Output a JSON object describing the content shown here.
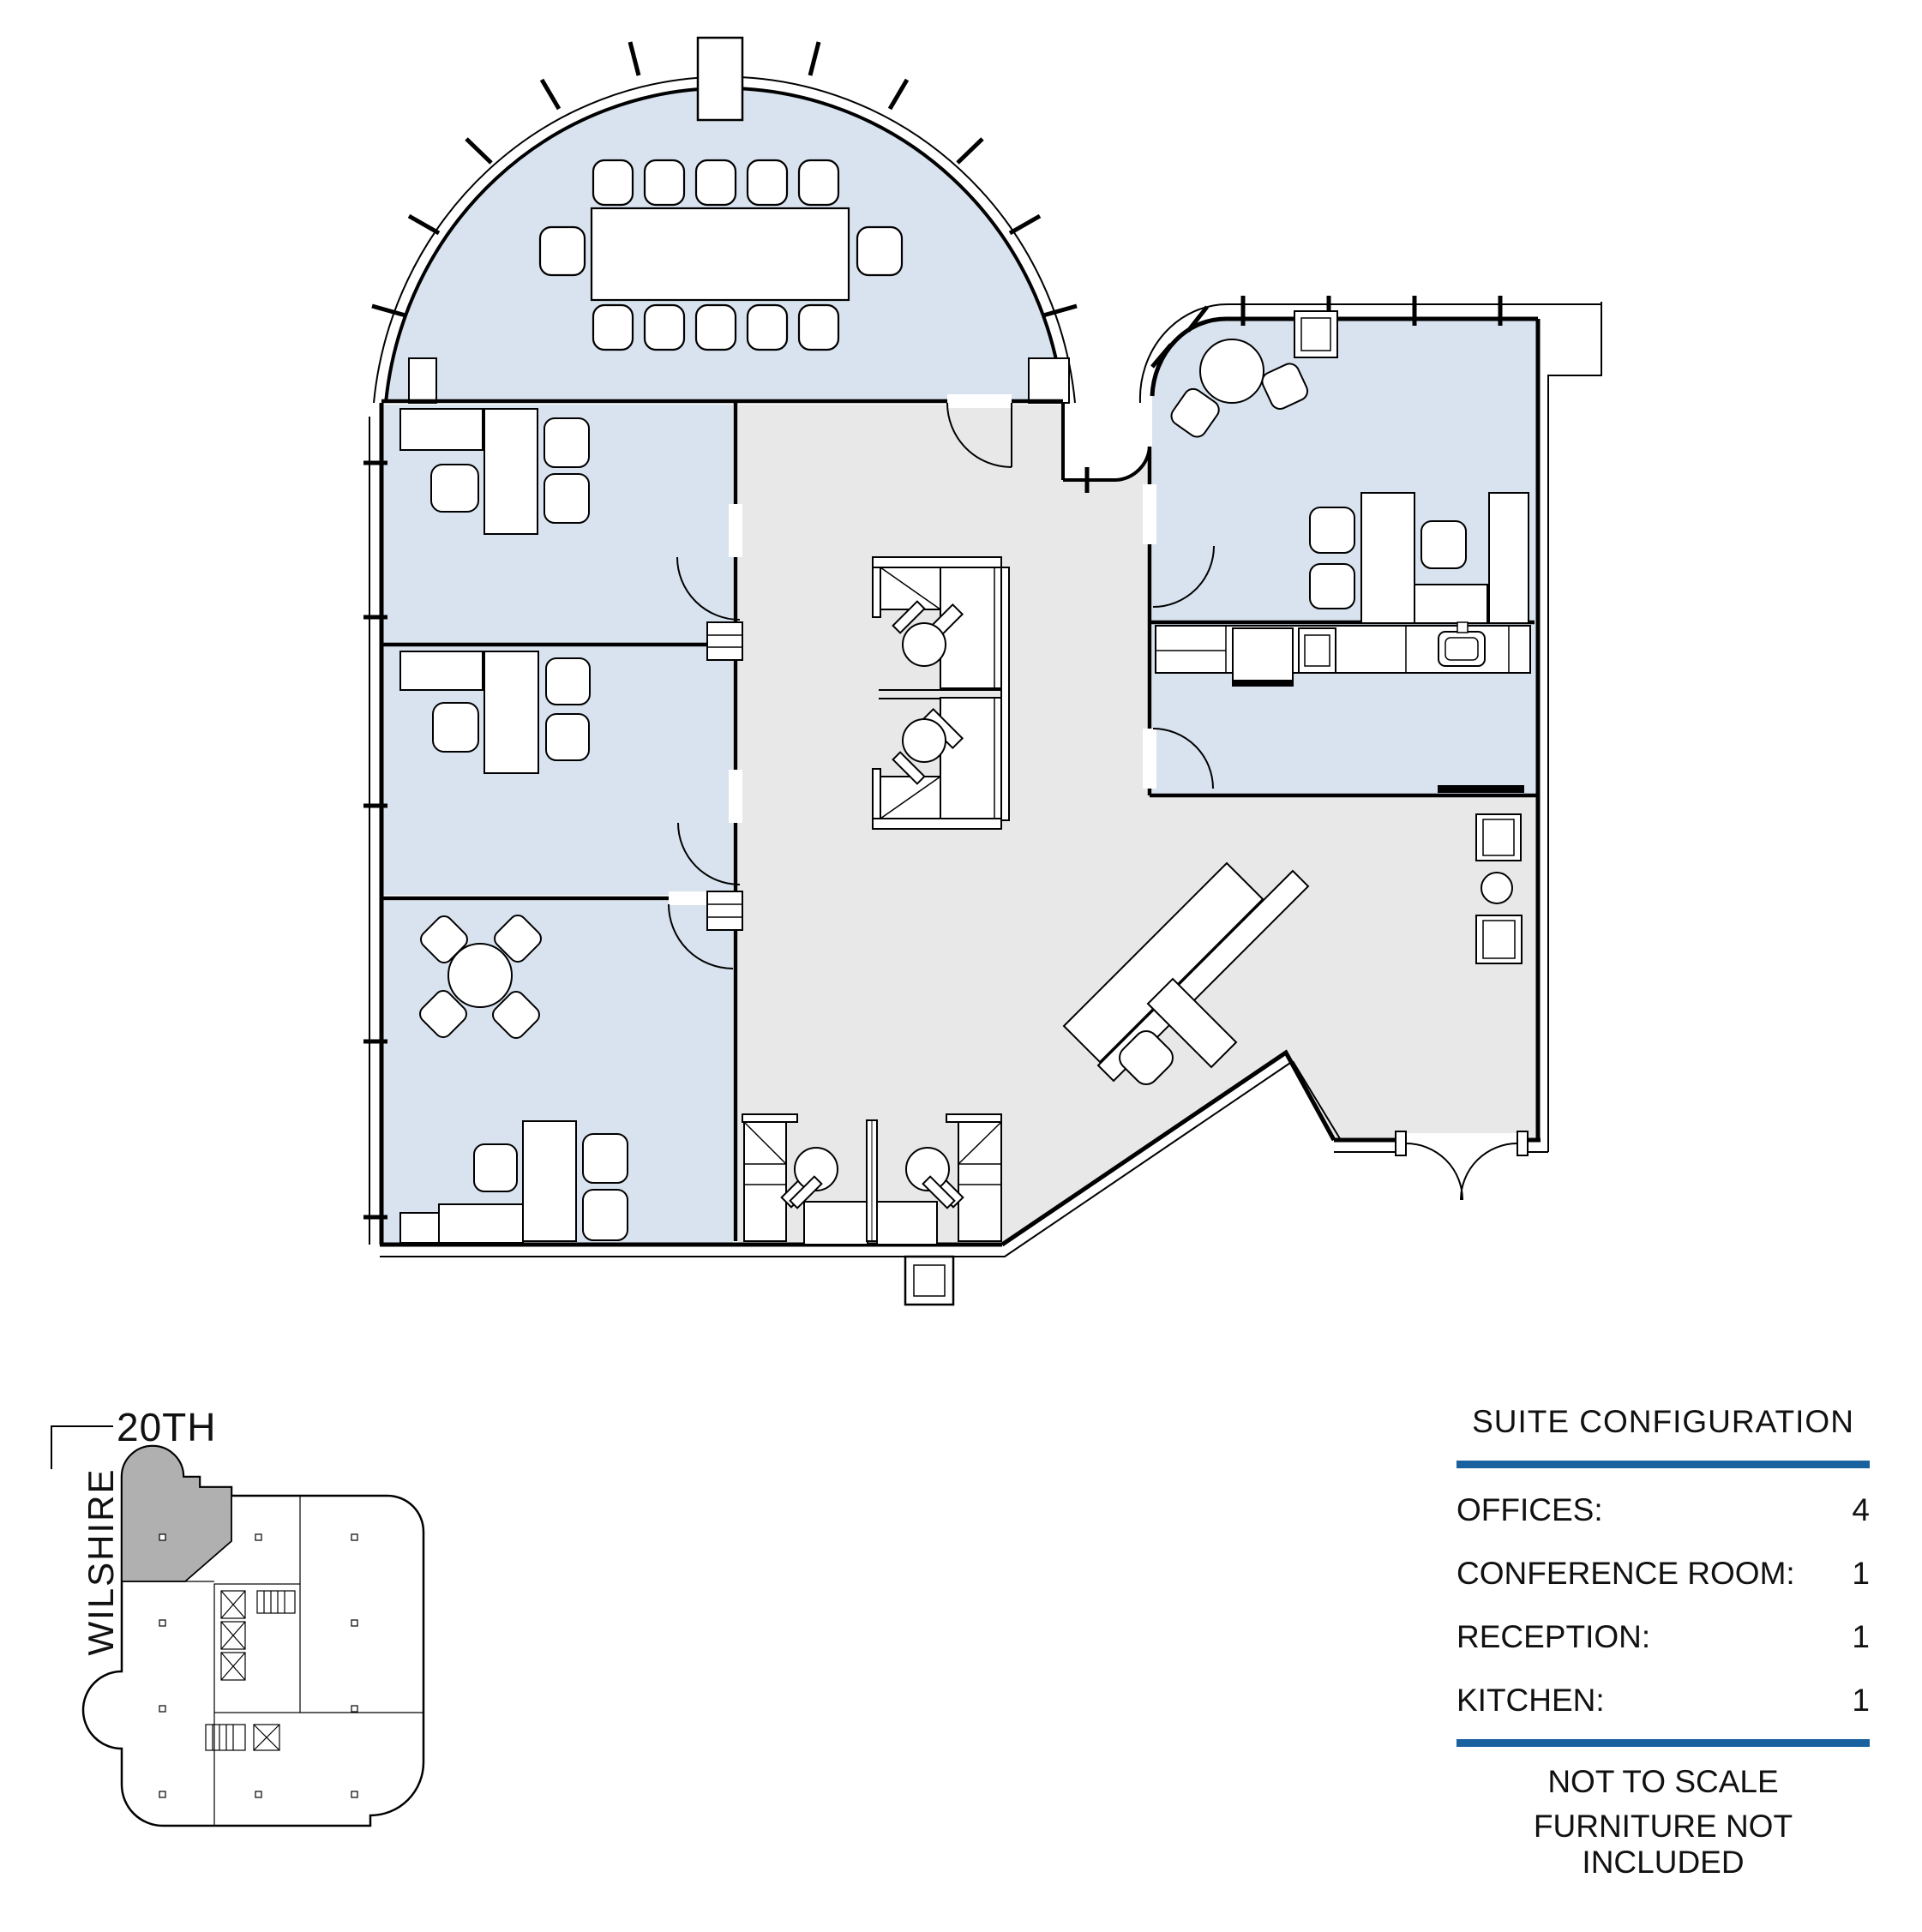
{
  "key_plan": {
    "street_top": "20TH",
    "street_side": "WILSHIRE"
  },
  "suite_configuration": {
    "title": "SUITE CONFIGURATION",
    "rows": [
      {
        "label": "OFFICES:",
        "value": "4"
      },
      {
        "label": "CONFERENCE ROOM:",
        "value": "1"
      },
      {
        "label": "RECEPTION:",
        "value": "1"
      },
      {
        "label": "KITCHEN:",
        "value": "1"
      }
    ],
    "notes": [
      "NOT TO SCALE",
      "FURNITURE NOT INCLUDED"
    ]
  },
  "floor_plan": {
    "rooms": [
      {
        "name": "conference-room",
        "fill": "room_fill",
        "seats": 12
      },
      {
        "name": "office-1",
        "fill": "room_fill"
      },
      {
        "name": "office-2",
        "fill": "room_fill"
      },
      {
        "name": "office-3",
        "fill": "room_fill"
      },
      {
        "name": "office-4",
        "fill": "room_fill"
      },
      {
        "name": "kitchen",
        "fill": "room_fill"
      },
      {
        "name": "reception-common-area",
        "fill": "floor_fill"
      }
    ]
  },
  "colors": {
    "accent_blue": "#1a61a0",
    "room_fill": "#d8e3ef",
    "floor_fill": "#e8e8e8",
    "suite_highlight": "#b0b0b0",
    "wall_line": "#000000"
  }
}
